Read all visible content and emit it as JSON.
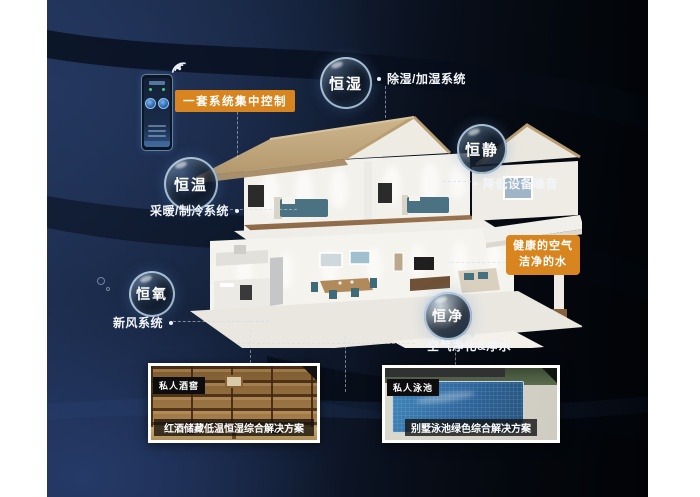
{
  "colors": {
    "accent_orange": "#d9851f",
    "canvas_navy": "#15223b",
    "bubble_rim": "#cde4f8"
  },
  "control": {
    "box_label": "一套系统集中控制"
  },
  "benefit": {
    "line1": "健康的空气",
    "line2": "洁净的水"
  },
  "bubbles": [
    {
      "label": "恒湿",
      "note": "除湿/加湿系统"
    },
    {
      "label": "恒静",
      "note": "降低设备噪音"
    },
    {
      "label": "恒温",
      "note": "采暖/制冷系统"
    },
    {
      "label": "恒氧",
      "note": "新风系统"
    },
    {
      "label": "恒净",
      "note": "空气净化&净水"
    }
  ],
  "photos": [
    {
      "tag": "私人酒窖",
      "caption": "红酒储藏低温恒湿综合解决方案"
    },
    {
      "tag": "私人泳池",
      "caption": "别墅泳池绿色综合解决方案"
    }
  ],
  "icons": {
    "wifi": "signal-arcs",
    "connector_dot": "•"
  }
}
